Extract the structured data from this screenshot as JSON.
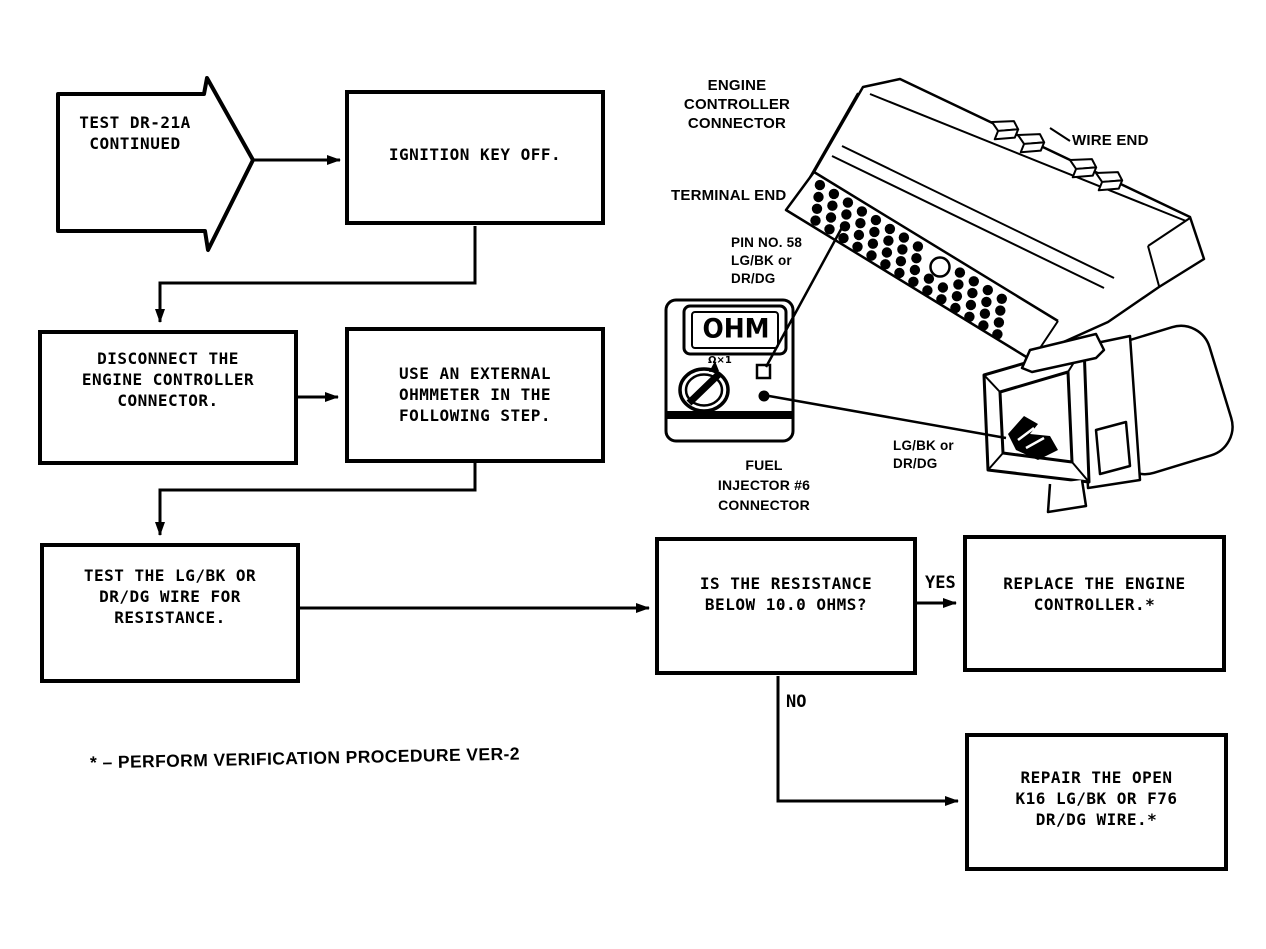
{
  "flowchart": {
    "start": {
      "label": "TEST DR-21A\nCONTINUED"
    },
    "boxes": {
      "ignition": {
        "label": "IGNITION KEY OFF."
      },
      "disconnect": {
        "label": "DISCONNECT THE\nENGINE CONTROLLER\nCONNECTOR."
      },
      "use_meter": {
        "label": "USE AN EXTERNAL\nOHMMETER IN THE\nFOLLOWING STEP."
      },
      "test_wire": {
        "label": "TEST THE LG/BK OR\nDR/DG WIRE FOR\nRESISTANCE."
      },
      "decision": {
        "label": "IS THE RESISTANCE\nBELOW 10.0 OHMS?"
      },
      "replace": {
        "label": "REPLACE THE ENGINE\nCONTROLLER.*"
      },
      "repair": {
        "label": "REPAIR THE OPEN\nK16 LG/BK OR F76\nDR/DG WIRE.*"
      }
    },
    "branch_labels": {
      "yes": "YES",
      "no": "NO"
    },
    "footnote": "* – PERFORM VERIFICATION PROCEDURE VER-2"
  },
  "illustration": {
    "labels": {
      "engine_controller_connector": "ENGINE\nCONTROLLER\nCONNECTOR",
      "wire_end": "WIRE END",
      "terminal_end": "TERMINAL END",
      "pin_no": "PIN NO. 58\nLG/BK or\nDR/DG",
      "fuel_injector": "FUEL\nINJECTOR #6\nCONNECTOR",
      "wire_colors": "LG/BK or\nDR/DG"
    },
    "ohmmeter": {
      "display": "OHM",
      "range": "Ω×1"
    }
  },
  "colors": {
    "ink": "#000000",
    "paper": "#ffffff"
  }
}
